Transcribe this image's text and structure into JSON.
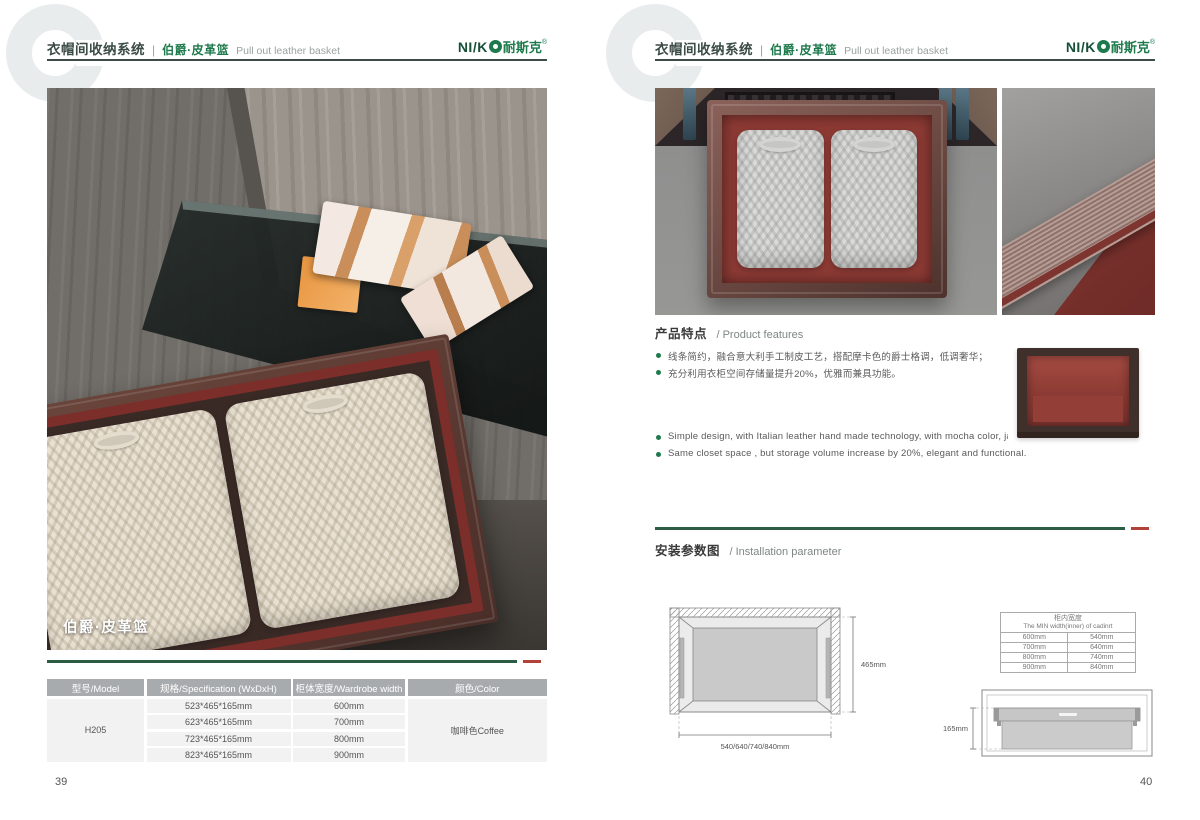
{
  "header": {
    "watermark_letter": "C",
    "system_title_zh": "衣帽间收纳系统",
    "separator": "|",
    "product_name_zh": "伯爵·皮革篮",
    "product_name_en": "Pull out leather basket",
    "brand": {
      "latin_prefix": "NI/K",
      "zh": "耐斯克",
      "reg": "®"
    }
  },
  "left_page": {
    "page_number": "39",
    "photo_caption": "伯爵·皮革篮",
    "spec_table": {
      "headers": [
        "型号/Model",
        "规格/Specification (WxDxH)",
        "柜体宽度/Wardrobe width",
        "颜色/Color"
      ],
      "model": "H205",
      "rows": [
        {
          "spec": "523*465*165mm",
          "width": "600mm"
        },
        {
          "spec": "623*465*165mm",
          "width": "700mm"
        },
        {
          "spec": "723*465*165mm",
          "width": "800mm"
        },
        {
          "spec": "823*465*165mm",
          "width": "900mm"
        }
      ],
      "color": "咖啡色Coffee"
    }
  },
  "right_page": {
    "page_number": "40",
    "features": {
      "title_zh": "产品特点",
      "title_en": "/ Product features",
      "bullets_zh": [
        "线条简约，融合意大利手工制皮工艺，搭配摩卡色的爵士格调，低调奢华；",
        "充分利用衣柜空间存储量提升20%，优雅而兼具功能。"
      ],
      "bullets_en": [
        "Simple design, with Italian leather hand made technology, with mocha color, jazz  luxury;",
        "Same closet space ,  but storage volume increase by 20%, elegant and functional."
      ]
    },
    "installation": {
      "title_zh": "安装参数图",
      "title_en": "/ Installation parameter",
      "top_view": {
        "depth": "465mm",
        "widths": "540/640/740/840mm"
      },
      "min_width_table": {
        "title_zh": "柜内宽度",
        "title_en": "The MIN width(inner) of cadinrt",
        "rows": [
          {
            "outer": "600mm",
            "inner": "540mm"
          },
          {
            "outer": "700mm",
            "inner": "640mm"
          },
          {
            "outer": "800mm",
            "inner": "740mm"
          },
          {
            "outer": "900mm",
            "inner": "840mm"
          }
        ]
      },
      "side_view": {
        "height": "165mm"
      }
    }
  },
  "colors": {
    "accent_green": "#1e7a4c",
    "divider_green": "#2d5c44",
    "divider_red": "#b2413a",
    "header_text": "#3b4b46",
    "table_header_bg": "#a8abae",
    "table_row_bg": "#f2f2f3",
    "basket_leather_red": "#8d3a34",
    "basket_frame_brown": "#4e322c"
  }
}
